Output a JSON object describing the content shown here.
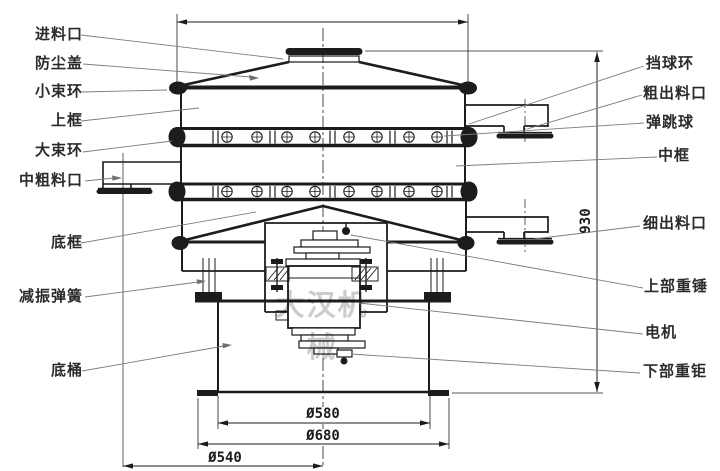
{
  "drawing": {
    "watermark": "大汉机械",
    "labels_left": [
      {
        "id": "feed-inlet",
        "text": "进料口"
      },
      {
        "id": "dust-cover",
        "text": "防尘盖"
      },
      {
        "id": "small-clamp-ring",
        "text": "小束环"
      },
      {
        "id": "upper-frame",
        "text": "上框"
      },
      {
        "id": "large-clamp-ring",
        "text": "大束环"
      },
      {
        "id": "middle-coarse-outlet",
        "text": "中粗料口"
      },
      {
        "id": "bottom-frame",
        "text": "底框"
      },
      {
        "id": "damping-spring",
        "text": "减振弹簧"
      },
      {
        "id": "base-barrel",
        "text": "底桶"
      }
    ],
    "labels_right": [
      {
        "id": "ball-stop-ring",
        "text": "挡球环"
      },
      {
        "id": "coarse-outlet",
        "text": "粗出料口"
      },
      {
        "id": "bouncing-ball",
        "text": "弹跳球"
      },
      {
        "id": "middle-frame",
        "text": "中框"
      },
      {
        "id": "fine-outlet",
        "text": "细出料口"
      },
      {
        "id": "upper-weight",
        "text": "上部重锤"
      },
      {
        "id": "motor",
        "text": "电机"
      },
      {
        "id": "lower-weight",
        "text": "下部重钜"
      }
    ],
    "dimensions": {
      "height": "930",
      "barrel_diameter": "Ø580",
      "flange_diameter": "Ø680",
      "outlet_circle_diameter": "Ø540"
    },
    "colors": {
      "line": "#1c1c1c",
      "leader": "#7d7d7d",
      "watermark": "#c3c3c3",
      "background": "#ffffff"
    }
  }
}
